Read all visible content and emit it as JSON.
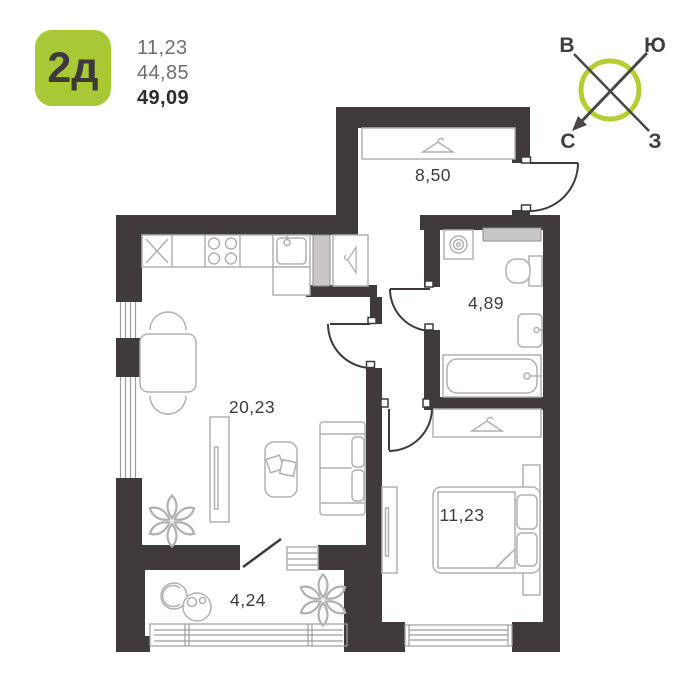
{
  "header": {
    "badge_label": "2д",
    "areas": [
      "11,23",
      "44,85",
      "49,09"
    ]
  },
  "compass": {
    "east": "В",
    "south": "Ю",
    "north": "С",
    "west": "З"
  },
  "rooms": {
    "hallway": {
      "area": "8,50"
    },
    "bathroom": {
      "area": "4,89"
    },
    "living": {
      "area": "20,23"
    },
    "bedroom": {
      "area": "11,23"
    },
    "balcony": {
      "area": "4,24"
    }
  },
  "colors": {
    "wall": "#3f3b3d",
    "accent_green": "#a9c836",
    "compass_green": "#b6cc35",
    "furniture_line": "#b2b0b1",
    "vent_fill": "#c8c6c7",
    "label_text": "#3c3c3c",
    "muted_text": "#6f6f6f",
    "total_text": "#2e2c2d"
  },
  "icons": [
    "hanger-icon",
    "plant-icon",
    "washing-machine-icon",
    "stove-burners-icon",
    "kitchen-sink-icon",
    "bathroom-sink-icon",
    "toilet-icon",
    "bathtub-icon",
    "compass-icon",
    "door-arc",
    "window-glazing"
  ]
}
